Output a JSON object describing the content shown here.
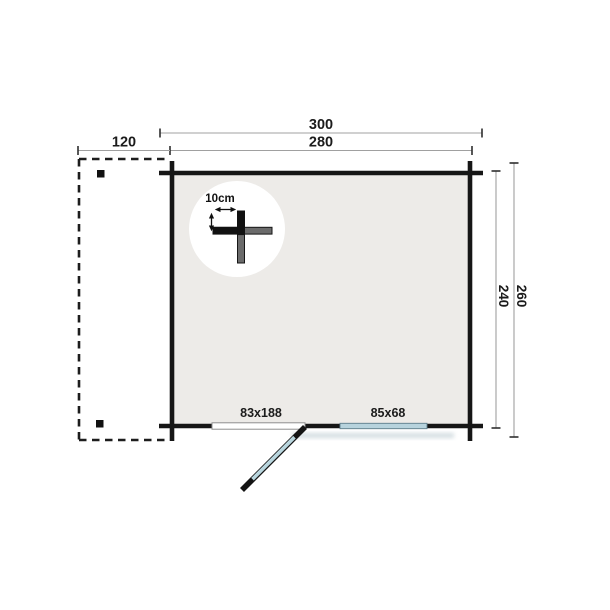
{
  "plan": {
    "type": "floor-plan",
    "unit": "cm",
    "top_dimensions": {
      "overall_width": "300",
      "cabin_width": "280",
      "canopy_width": "120"
    },
    "side_dimensions": {
      "overall_depth": "260",
      "cabin_depth": "240"
    },
    "detail": {
      "wall_thickness": "10cm"
    },
    "door": {
      "size": "83x188"
    },
    "window": {
      "size": "85x68"
    }
  },
  "colors": {
    "wall": "#161616",
    "interior": "#edebe8",
    "glazing": "#b7d3dd",
    "door_leaf": "#b9d6de",
    "dimension_line": "#a0a0a0",
    "text": "#1b1b1b",
    "shadow": "#9fb4bc"
  }
}
